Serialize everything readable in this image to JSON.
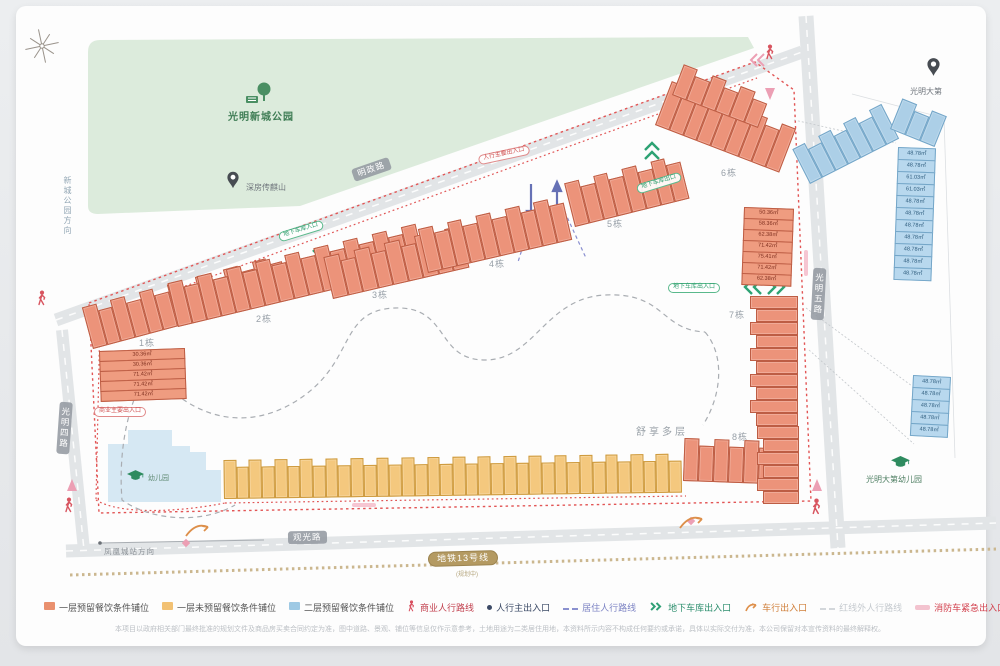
{
  "park": {
    "name": "光明新城公园"
  },
  "pins": {
    "site": "深房传麒山",
    "neighbor": "光明大第"
  },
  "kindergartens": {
    "inner": "幼儿园",
    "outer": "光明大第幼儿园"
  },
  "directions": {
    "left_vertical": "新城公园方向",
    "bottom": "凤凰城站方向"
  },
  "roads": {
    "top": "明政路",
    "right": "光明五路",
    "left": "光明四路",
    "bottom": "观光路"
  },
  "metro": {
    "label": "地铁13号线",
    "note": "(规划中)"
  },
  "site_note": "舒享多层",
  "pills": [
    {
      "name": "road-mingzheng",
      "text": "明政路",
      "x": 352,
      "y": 163,
      "rot": -19,
      "style": "road"
    },
    {
      "name": "road-guangwu",
      "text": "光明五路",
      "x": 812,
      "y": 268,
      "rot": 3,
      "style": "road",
      "vert": true
    },
    {
      "name": "road-guangsi",
      "text": "光明四路",
      "x": 58,
      "y": 402,
      "rot": 4,
      "style": "road",
      "vert": true
    },
    {
      "name": "road-guanguang",
      "text": "观光路",
      "x": 288,
      "y": 531,
      "rot": -1,
      "style": "road"
    },
    {
      "name": "metro-line",
      "text": "地铁13号线",
      "x": 428,
      "y": 551,
      "rot": -1.5,
      "style": "metro"
    },
    {
      "name": "main-ped-entry",
      "text": "人行主要出入口",
      "x": 478,
      "y": 150,
      "rot": -12,
      "style": "red"
    },
    {
      "name": "garage-in",
      "text": "地下车库入口",
      "x": 278,
      "y": 226,
      "rot": -17,
      "style": "green"
    },
    {
      "name": "garage-out-top",
      "text": "地下车库出口",
      "x": 636,
      "y": 178,
      "rot": -17,
      "style": "green"
    },
    {
      "name": "garage-inout",
      "text": "地下车库出入口",
      "x": 668,
      "y": 283,
      "rot": 0,
      "style": "green"
    },
    {
      "name": "biz-entry",
      "text": "商业主要出入口",
      "x": 94,
      "y": 407,
      "rot": 0,
      "style": "red"
    }
  ],
  "building_labels": [
    {
      "text": "1栋",
      "x": 139,
      "y": 336
    },
    {
      "text": "2栋",
      "x": 256,
      "y": 312
    },
    {
      "text": "3栋",
      "x": 372,
      "y": 288
    },
    {
      "text": "4栋",
      "x": 489,
      "y": 257
    },
    {
      "text": "5栋",
      "x": 607,
      "y": 217
    },
    {
      "text": "6栋",
      "x": 721,
      "y": 166
    },
    {
      "text": "7栋",
      "x": 729,
      "y": 308
    },
    {
      "text": "8栋",
      "x": 732,
      "y": 430
    }
  ],
  "strips": [
    {
      "x": 93,
      "y": 306,
      "w": 205,
      "h": 36,
      "rot": -15,
      "cells": 14,
      "type": "a"
    },
    {
      "x": 178,
      "y": 282,
      "w": 255,
      "h": 38,
      "rot": -13.5,
      "cells": 17,
      "type": "a"
    },
    {
      "x": 333,
      "y": 256,
      "w": 140,
      "h": 36,
      "rot": -13,
      "cells": 9,
      "type": "a"
    },
    {
      "x": 428,
      "y": 228,
      "w": 148,
      "h": 38,
      "rot": -13,
      "cells": 10,
      "type": "a"
    },
    {
      "x": 575,
      "y": 182,
      "w": 118,
      "h": 38,
      "rot": -14,
      "cells": 8,
      "type": "a"
    },
    {
      "x": 655,
      "y": 78,
      "w": 133,
      "h": 40,
      "rot": 21,
      "cells": 9,
      "type": "a"
    },
    {
      "x": 672,
      "y": 62,
      "w": 92,
      "h": 26,
      "rot": 21,
      "cells": 6,
      "type": "a"
    },
    {
      "x": 683,
      "y": 438,
      "w": 105,
      "h": 36,
      "rot": 2,
      "cells": 7,
      "type": "a"
    },
    {
      "x": 224,
      "y": 460,
      "w": 458,
      "h": 32,
      "rot": -0.8,
      "cells": 36,
      "type": "b"
    },
    {
      "x": 810,
      "y": 145,
      "w": 100,
      "h": 32,
      "rot": -27,
      "cells": 7,
      "type": "c"
    },
    {
      "x": 890,
      "y": 96,
      "w": 48,
      "h": 26,
      "rot": 22,
      "cells": 3,
      "type": "c"
    }
  ],
  "vstrips": [
    {
      "x": 750,
      "y": 296,
      "w": 42,
      "cells": 10,
      "rowH": 13,
      "type": "a"
    },
    {
      "x": 757,
      "y": 426,
      "w": 36,
      "cells": 6,
      "rowH": 13,
      "type": "a"
    }
  ],
  "stacks": [
    {
      "x": 99,
      "y": 352,
      "w": 86,
      "rowH": 11,
      "rot": -2,
      "type": "a",
      "areas": [
        "30.36㎡",
        "30.36㎡",
        "71.42㎡",
        "71.42㎡",
        "71.42㎡"
      ]
    },
    {
      "x": 744,
      "y": 208,
      "w": 50,
      "rowH": 12,
      "rot": 2,
      "type": "a",
      "areas": [
        "50.36㎡",
        "58.36㎡",
        "62.38㎡",
        "71.42㎡",
        "75.41㎡",
        "71.42㎡",
        "62.38㎡"
      ]
    },
    {
      "x": 898,
      "y": 148,
      "w": 38,
      "rowH": 13,
      "rot": 2,
      "type": "c",
      "areas": [
        "48.78㎡",
        "48.78㎡",
        "61.03㎡",
        "61.03㎡",
        "48.78㎡",
        "48.78㎡",
        "48.78㎡",
        "48.78㎡",
        "48.78㎡",
        "48.78㎡",
        "48.78㎡"
      ]
    },
    {
      "x": 913,
      "y": 376,
      "w": 38,
      "rowH": 13,
      "rot": 3,
      "type": "c",
      "areas": [
        "48.78㎡",
        "48.78㎡",
        "48.78㎡",
        "48.78㎡",
        "48.78㎡"
      ]
    }
  ],
  "legend": [
    {
      "kind": "swatch",
      "color": "#e9906e",
      "label": "一层预留餐饮条件铺位",
      "text": "#555555"
    },
    {
      "kind": "swatch",
      "color": "#f2c173",
      "label": "一层未预留餐饮条件铺位",
      "text": "#555555"
    },
    {
      "kind": "swatch",
      "color": "#9ec9e4",
      "label": "二层预留餐饮条件铺位",
      "text": "#555555"
    },
    {
      "kind": "person",
      "color": "#d84f5f",
      "label": "商业人行路线",
      "text": "#c2414f"
    },
    {
      "kind": "dot",
      "color": "#3c4a66",
      "label": "人行主出入口",
      "text": "#3c4a66"
    },
    {
      "kind": "dashes",
      "color": "#8a90cf",
      "label": "居住人行路线",
      "text": "#7d84c4"
    },
    {
      "kind": "chevrons",
      "color": "#2fa076",
      "label": "地下车库出入口",
      "text": "#2c8e6d"
    },
    {
      "kind": "curve",
      "color": "#de8f4a",
      "label": "车行出入口",
      "text": "#d07f3a"
    },
    {
      "kind": "dashes",
      "color": "#d3d7db",
      "label": "红线外人行路线",
      "text": "#c5cacf"
    },
    {
      "kind": "bar",
      "color": "#f3c3cf",
      "label": "消防车紧急出入口",
      "text": "#d2404d"
    }
  ],
  "disclaimer": "本项目以政府相关部门最终批准的规划文件及商品房买卖合同约定为准，图中道路、景观、铺位等信息仅作示意参考，土地用途为二类居住用地，本资料所示内容不构成任何要约或承诺，具体以实际交付为准，本公司保留对本宣传资料的最终解释权。"
}
